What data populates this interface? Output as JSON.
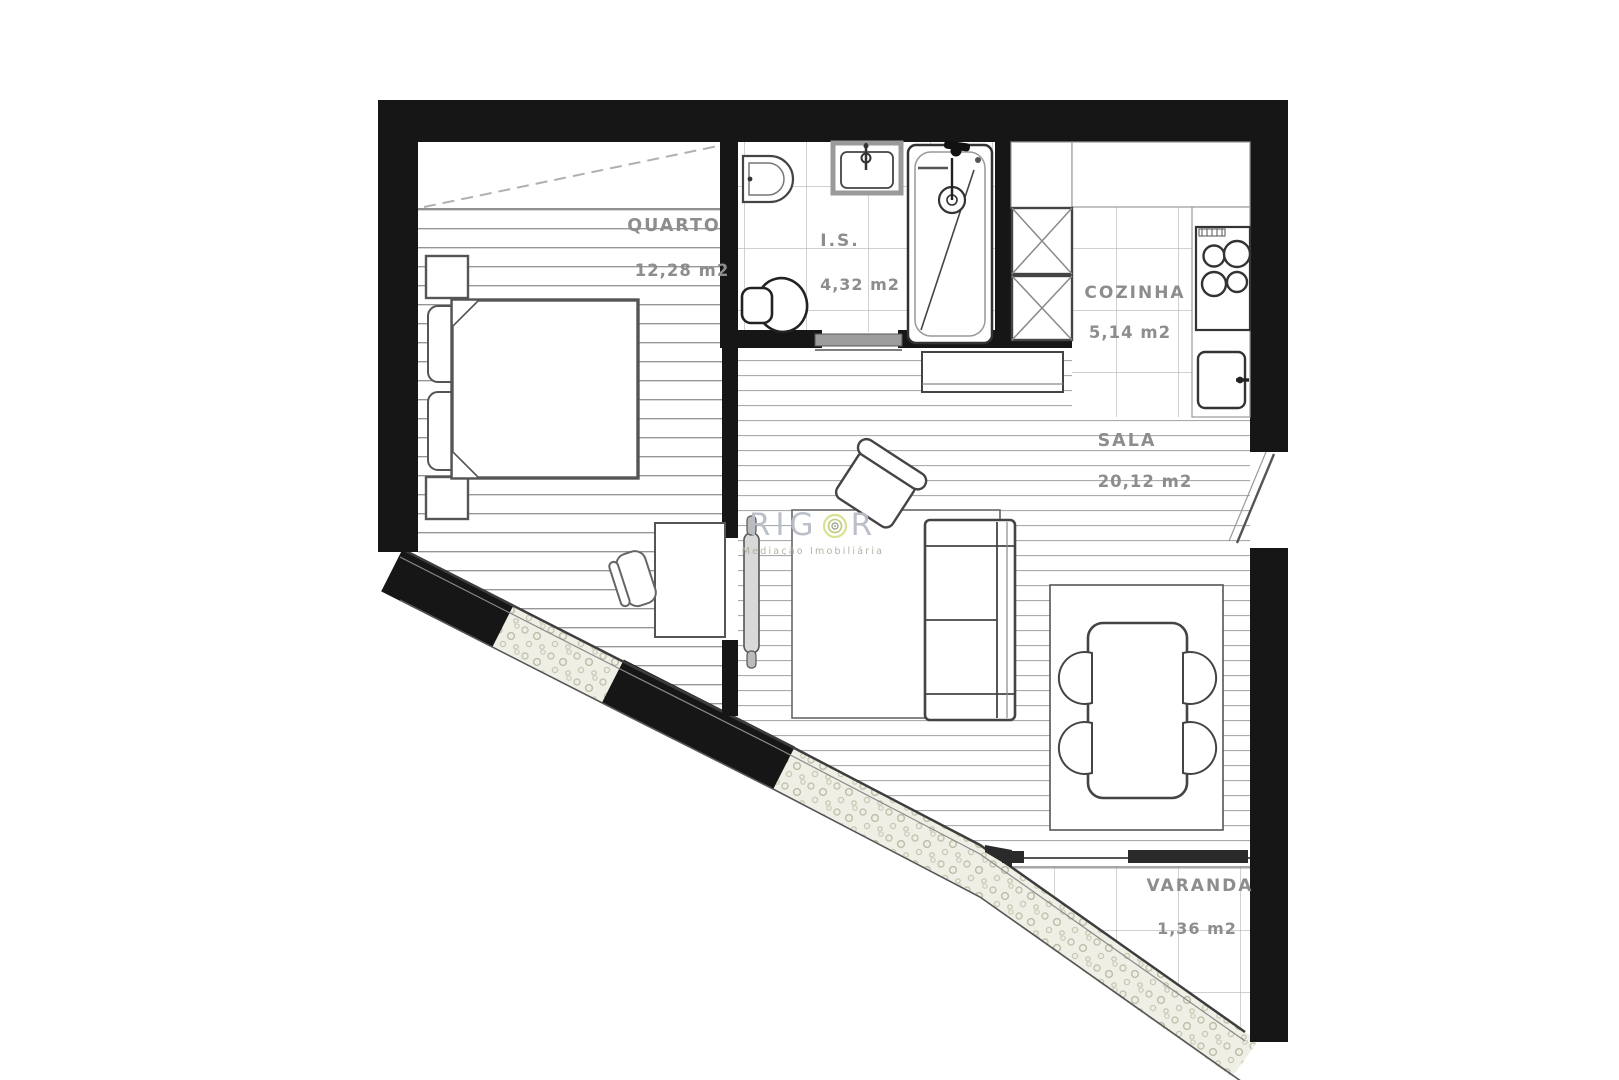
{
  "floor_plan": {
    "rooms": {
      "quarto": {
        "name": "QUARTO",
        "area": "12,28 m2"
      },
      "is": {
        "name": "I.S.",
        "area": "4,32 m2"
      },
      "cozinha": {
        "name": "COZINHA",
        "area": "5,14 m2"
      },
      "sala": {
        "name": "SALA",
        "area": "20,12 m2"
      },
      "varanda": {
        "name": "VARANDA",
        "area": "1,36 m2"
      }
    }
  },
  "watermark": {
    "brand_left": "RIG",
    "brand_right": "R",
    "tagline": "Mediação Imobiliária"
  },
  "colors": {
    "wall": "#161616",
    "label": "#8d8d8d",
    "brand": "#b8bdc6",
    "ring_outer": "#d8e08c",
    "ring_inner": "#9aa38c",
    "tagline": "#a9b2a0"
  }
}
